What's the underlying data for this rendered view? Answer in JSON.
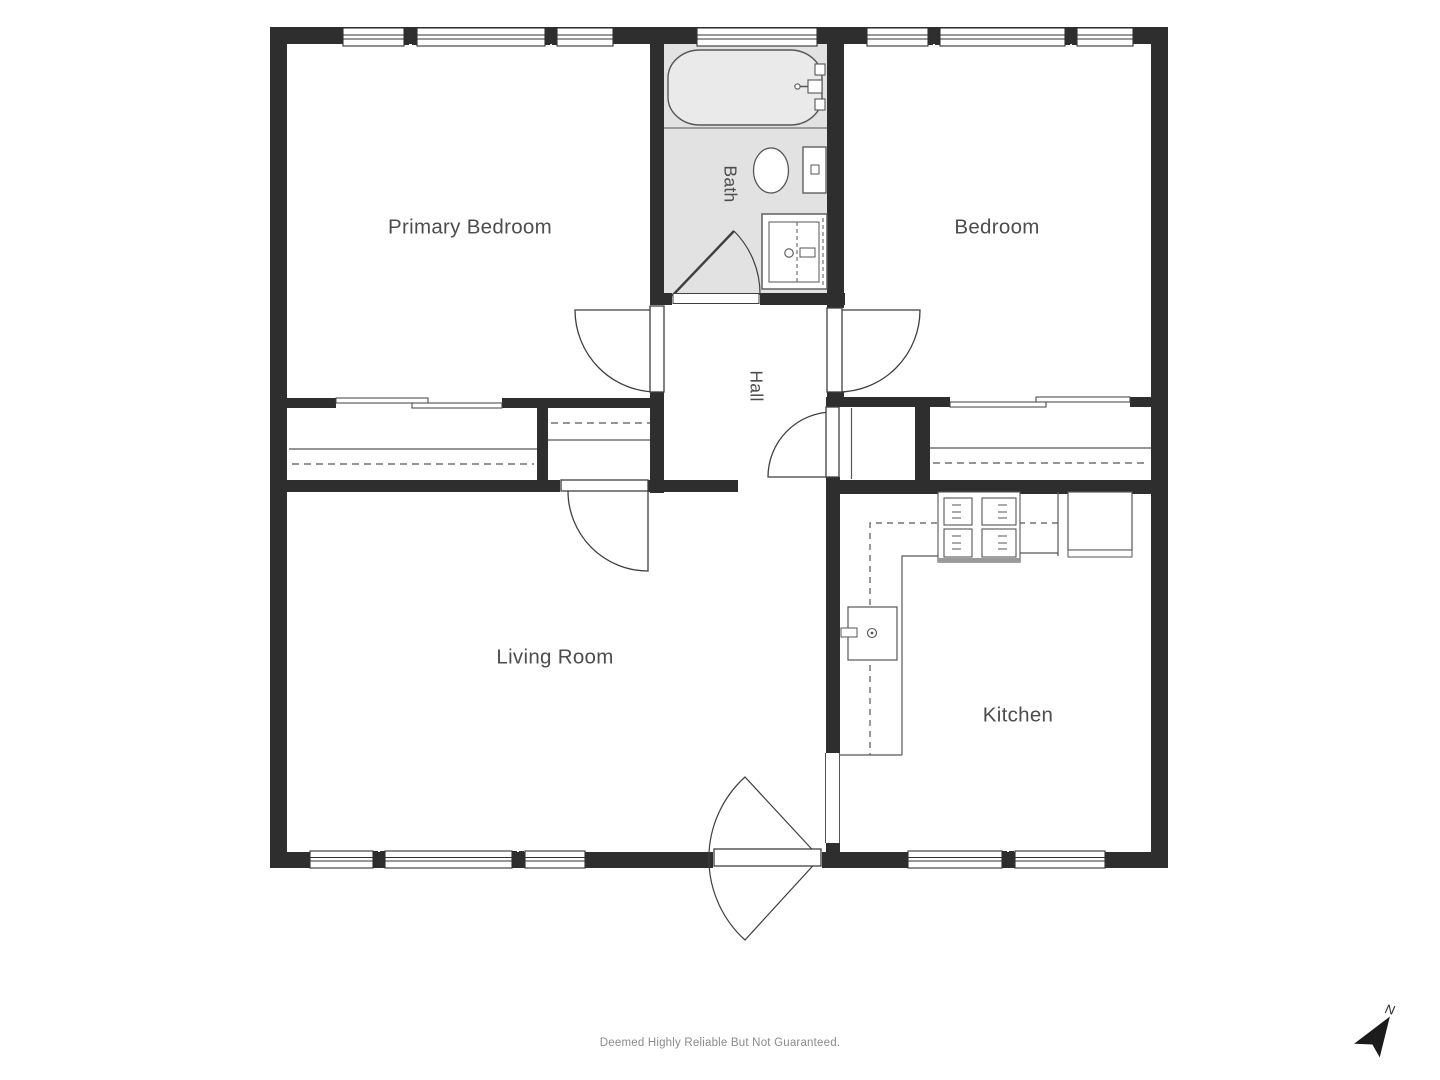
{
  "rooms": {
    "primary_bedroom": "Primary Bedroom",
    "bedroom": "Bedroom",
    "bath": "Bath",
    "hall": "Hall",
    "living_room": "Living Room",
    "kitchen": "Kitchen"
  },
  "footer": {
    "disclaimer": "Deemed Highly Reliable But Not Guaranteed."
  },
  "compass": {
    "north_label": "N"
  },
  "fixtures": [
    "bathtub-icon",
    "toilet-icon",
    "vanity-sink-icon",
    "stove-icon",
    "refrigerator-icon",
    "kitchen-sink-icon",
    "compass-north-icon"
  ],
  "colors": {
    "wall": "#2e2e2e",
    "bath_floor": "#e2e2e2",
    "tub_fill": "#eaeaea",
    "line": "#565656",
    "window_line": "#333333",
    "door_line": "#3f3f3f",
    "label_text": "#4d4d4d",
    "footer_text": "#8a8a8a",
    "compass": "#1c1c1c"
  }
}
